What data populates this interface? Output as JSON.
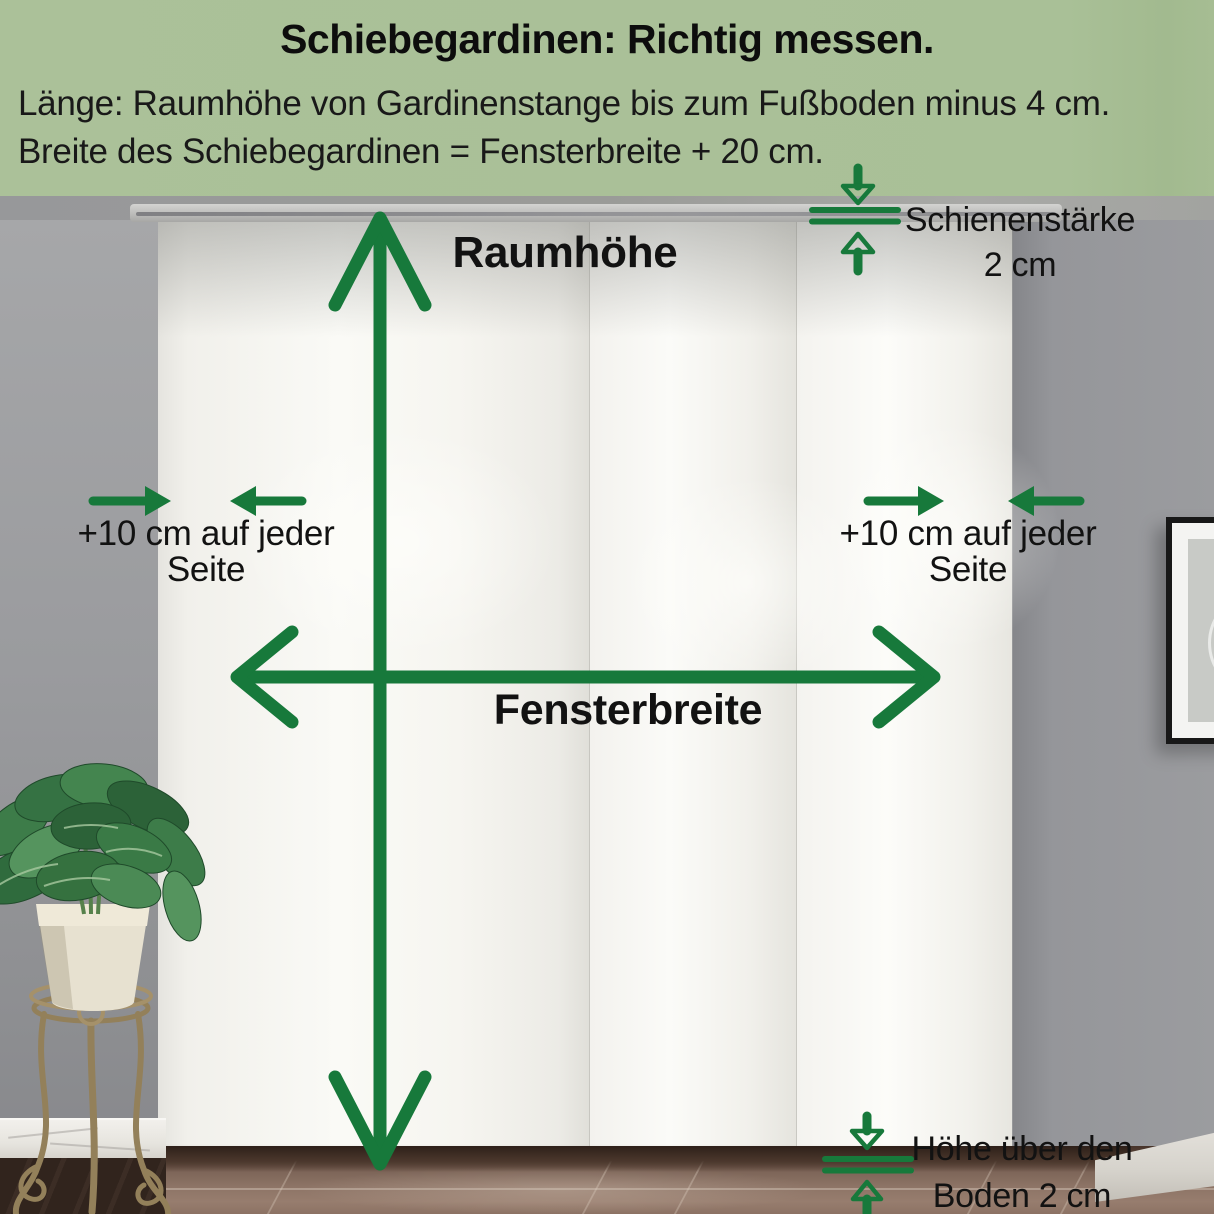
{
  "header": {
    "title": "Schiebegardinen: Richtig messen.",
    "line1": "Länge: Raumhöhe von Gardinenstange bis zum Fußboden minus 4 cm.",
    "line2": "Breite des Schiebegardinen = Fensterbreite + 20 cm."
  },
  "annotations": {
    "room_height": "Raumhöhe",
    "window_width": "Fensterbreite",
    "left_offset_line1": "+10 cm auf jeder",
    "left_offset_line2": "Seite",
    "right_offset_line1": "+10 cm auf jeder",
    "right_offset_line2": "Seite",
    "rail_thickness_line1": "Schienenstärke",
    "rail_thickness_line2": "2 cm",
    "floor_gap_line1": "Höhe über den",
    "floor_gap_line2": "Boden 2 cm"
  },
  "colors": {
    "header_background": "#a9c097",
    "annotation_green": "#17793b",
    "text": "#121212",
    "curtain_white": "#f6f5f0",
    "wall_gray": "#97989a"
  }
}
